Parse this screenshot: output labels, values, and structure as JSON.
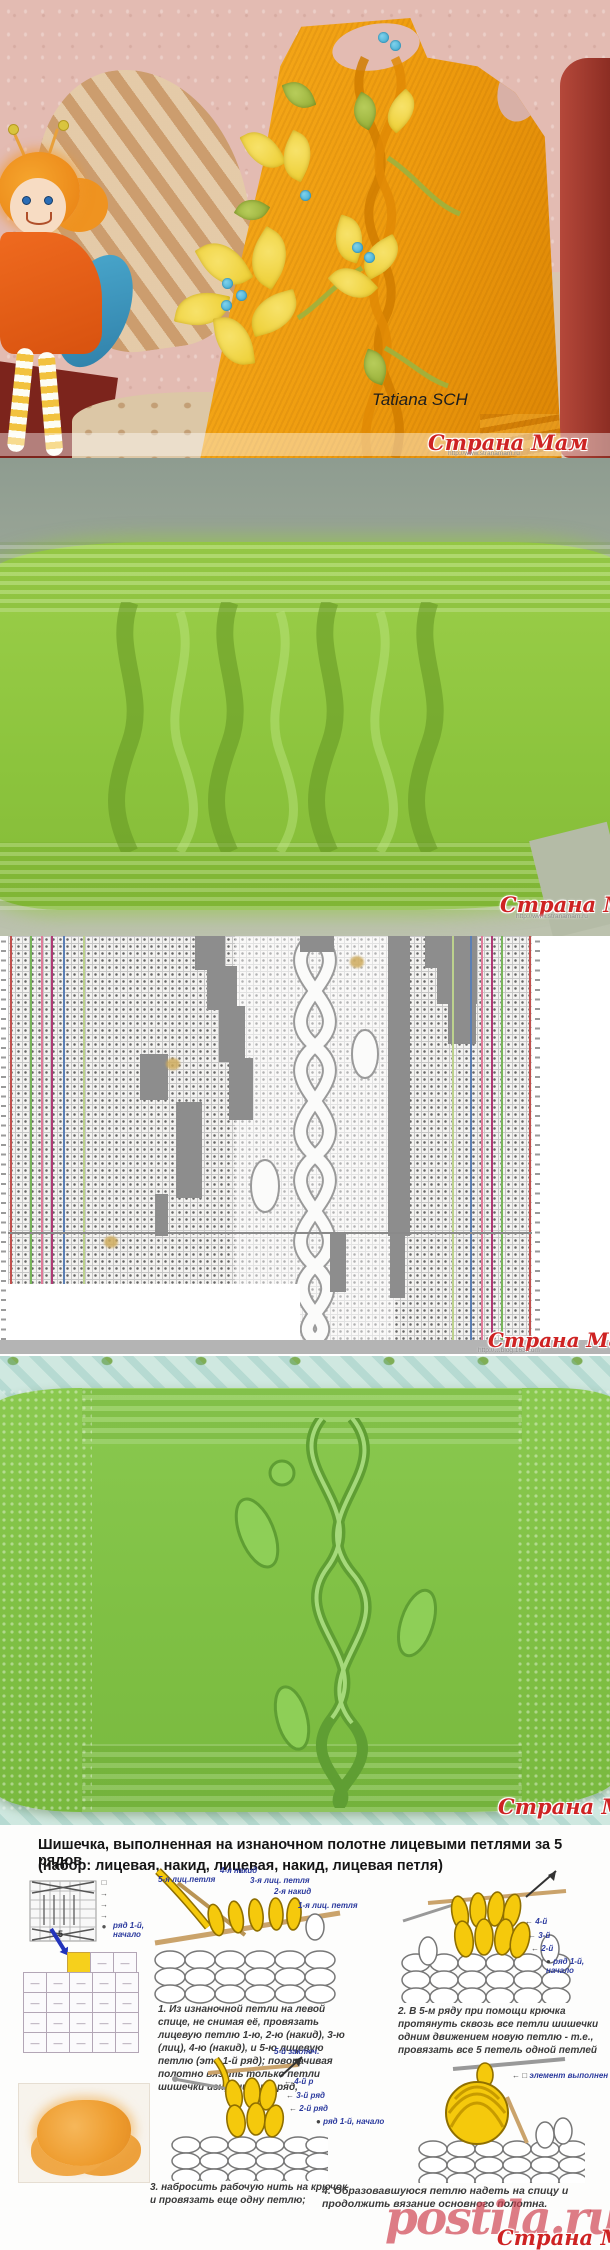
{
  "brand": {
    "watermark": "Страна Мам",
    "site_url": "http://www.stranamam.ru",
    "chart_source_url": "http://…blog.163.com",
    "postila": "postila.ru"
  },
  "photo1": {
    "credit": "Tatiana SCH"
  },
  "icons": {
    "arrow_left": "←",
    "arrow_right": "→",
    "dot": "●",
    "square": "□",
    "purl_dash": "—"
  },
  "instructions": {
    "title_line1": "Шишечка, выполненная на изнаночном полотне лицевыми петлями за 5 рядов",
    "title_line2": "(набор:  лицевая, накид, лицевая, накид, лицевая петля)",
    "row_start_label": "ряд 1-й, начало",
    "mini_chart_number": "5",
    "step1": {
      "labels": [
        "5-я лиц.петля",
        "4-я накид",
        "3-я лиц. петля",
        "2-я накид",
        "1-я лиц. петля"
      ],
      "text": "1. Из изнаночной петли на левой спице, не снимая её, провязать лицевую петлю 1-ю, 2-ю (накид), 3-ю (лиц), 4-ю (накид), и 5-ю лицевую петлю (это 1-й ряд); поворачивая полотно вязать только петли шишечки изн, лиц., изн ряд,"
    },
    "step2": {
      "labels": [
        "4-й",
        "3-й",
        "2-й"
      ],
      "text": "2. В 5-м ряду при помощи крючка протянуть сквозь все петли шишечки одним движением новую петлю - т.е., провязать все 5 петель одной  петлей"
    },
    "step3": {
      "top_label": "5-й заключ.",
      "labels": [
        "4-й р",
        "3-й ряд",
        "2-й ряд"
      ],
      "text": "3. набросить рабочую нить на крючок и провязать еще одну петлю;"
    },
    "step4": {
      "done_label": "элемент выполнен",
      "text": "4.   Образовавшуюся петлю надеть на спицу и продолжить вязание основного полотна."
    }
  },
  "colors": {
    "watermark_red": "#ce2323",
    "postila_pink": "#cd3e4c",
    "label_blue": "#2b3a9e",
    "bobble_yellow": "#f5c90c",
    "dress_orange": "#ef9c0e",
    "swatch_green_fuzzy": "#8cc43d",
    "swatch_green_smooth": "#7fc044",
    "chart_line_red": "#c0504d",
    "chart_line_green": "#77b55a",
    "chart_line_pink": "#e07b9a",
    "chart_line_magenta": "#b03a75",
    "chart_line_blue": "#5b7fb4",
    "chart_line_lightgreen": "#bcd28d"
  }
}
